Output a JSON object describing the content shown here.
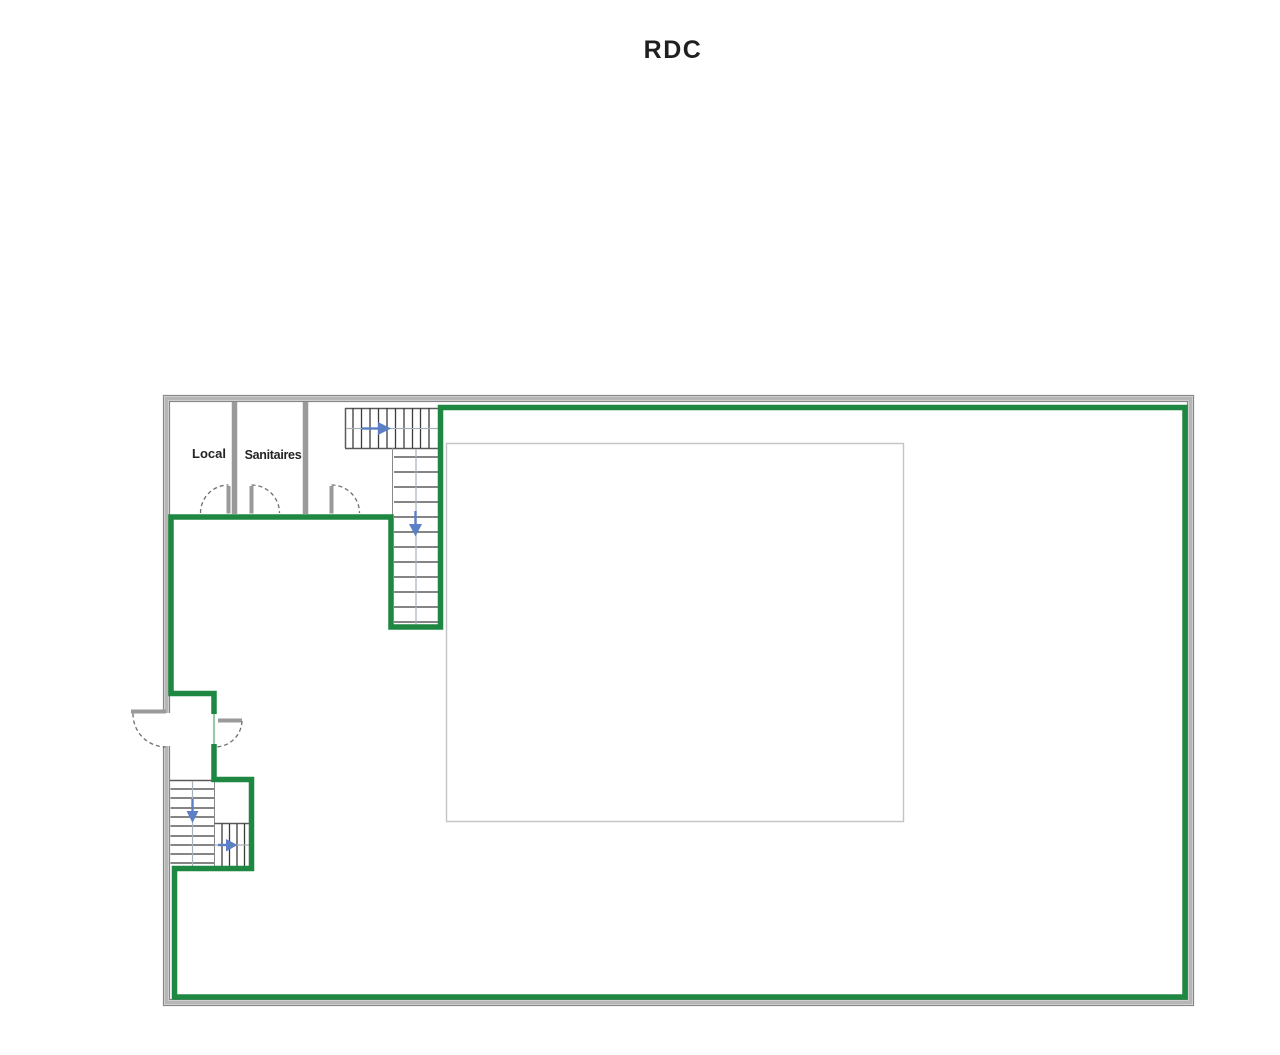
{
  "title": "RDC",
  "floor_plan": {
    "rooms": [
      {
        "label": "Local"
      },
      {
        "label": "Sanitaires"
      }
    ],
    "icons": {
      "stair_direction_right": "right-arrow",
      "stair_direction_down": "down-arrow"
    },
    "colors": {
      "zone_outline": "#1e8742",
      "zone_outline_faint": "#9cc9ac",
      "wall_band": "#b6b6b6",
      "wall_edge": "#878787",
      "interior_wall": "#9a9a9a",
      "stair_tread": "#3c3c3c",
      "stair_edge": "#5a5a5a",
      "stair_center": "#a8b0bc",
      "door_arc": "#6f6f6f",
      "arrow_blue": "#5b80c6",
      "inner_rect_border": "#c4c4c4",
      "text": "#1f1f1f"
    }
  }
}
